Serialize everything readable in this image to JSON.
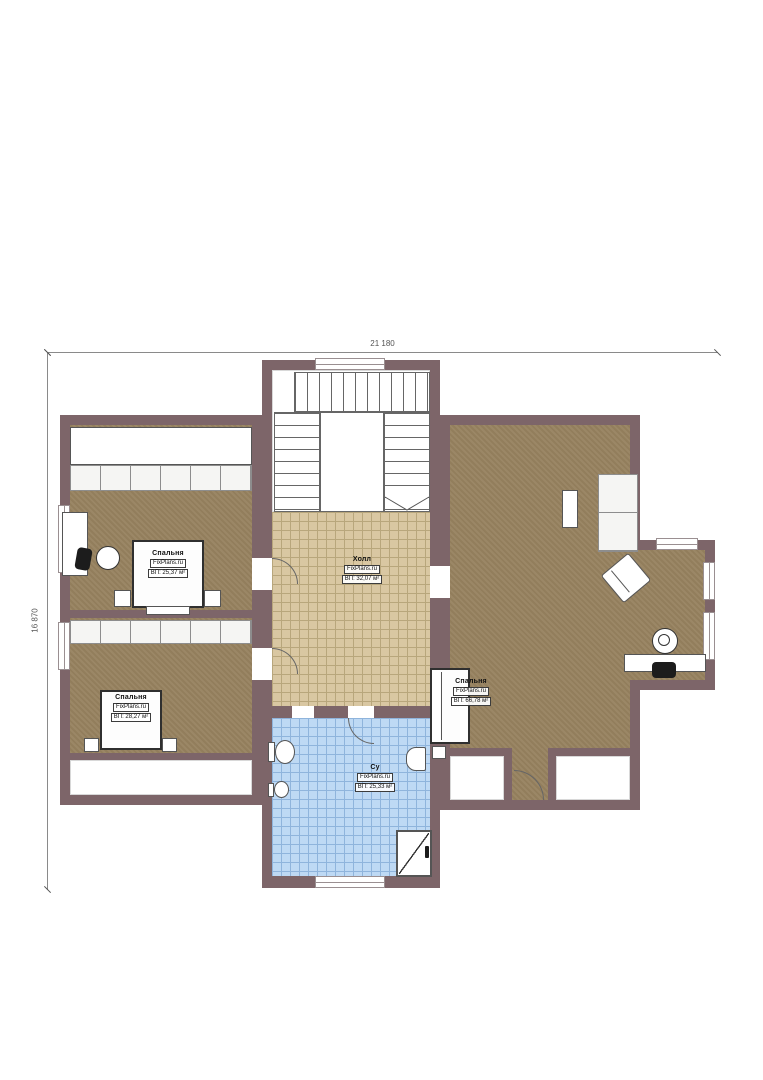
{
  "dimensions": {
    "width_label": "21 180",
    "height_label": "16 870"
  },
  "rooms": [
    {
      "id": "bedroom-1",
      "name": "Спальня",
      "brand": "FixPlans.ru",
      "area": "ВП: 25,37 м²"
    },
    {
      "id": "bedroom-2",
      "name": "Спальня",
      "brand": "FixPlans.ru",
      "area": "ВП: 28,27 м²"
    },
    {
      "id": "bedroom-3",
      "name": "Спальня",
      "brand": "FixPlans.ru",
      "area": "ВП: 66,78 м²"
    },
    {
      "id": "hall",
      "name": "Холл",
      "brand": "FixPlans.ru",
      "area": "ВП: 32,07 м²"
    },
    {
      "id": "bathroom",
      "name": "Су",
      "brand": "FixPlans.ru",
      "area": "ВП: 25,33 м²"
    }
  ],
  "colors": {
    "wall": "#7d6569",
    "floor-brown": "#97825f",
    "tile-tan": "#d9c7a2",
    "tile-tan-line": "#b8a67c",
    "tile-blue": "#bed9f4",
    "tile-blue-line": "#8fb4dc",
    "ink": "#2f2f2f",
    "dim": "#8a8a8a"
  }
}
